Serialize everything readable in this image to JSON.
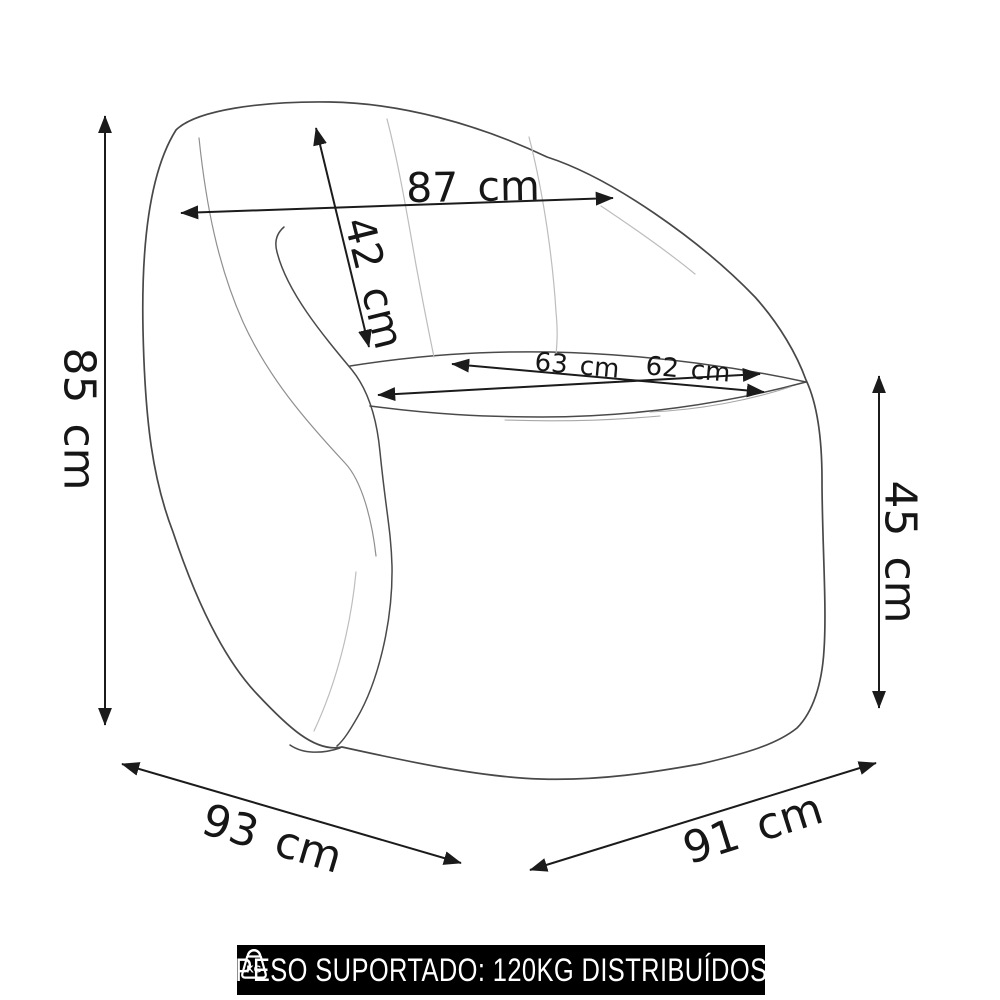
{
  "dimensions": {
    "total_height": "85 cm",
    "back_width": "87 cm",
    "backrest_height": "42 cm",
    "seat_depth": "63 cm",
    "seat_width": "62 cm",
    "seat_height": "45 cm",
    "base_depth": "93 cm",
    "base_width": "91 cm"
  },
  "banner": {
    "icon": "kg-weight-icon",
    "icon_label": "KG",
    "text": "PESO SUPORTADO: 120KG DISTRIBUÍDOS"
  },
  "colors": {
    "background": "#ffffff",
    "chair_line": "#484848",
    "seam_line": "#bdbdbd",
    "dimension_line": "#1b1b1b",
    "banner_bg": "#000000",
    "banner_text": "#ffffff"
  }
}
